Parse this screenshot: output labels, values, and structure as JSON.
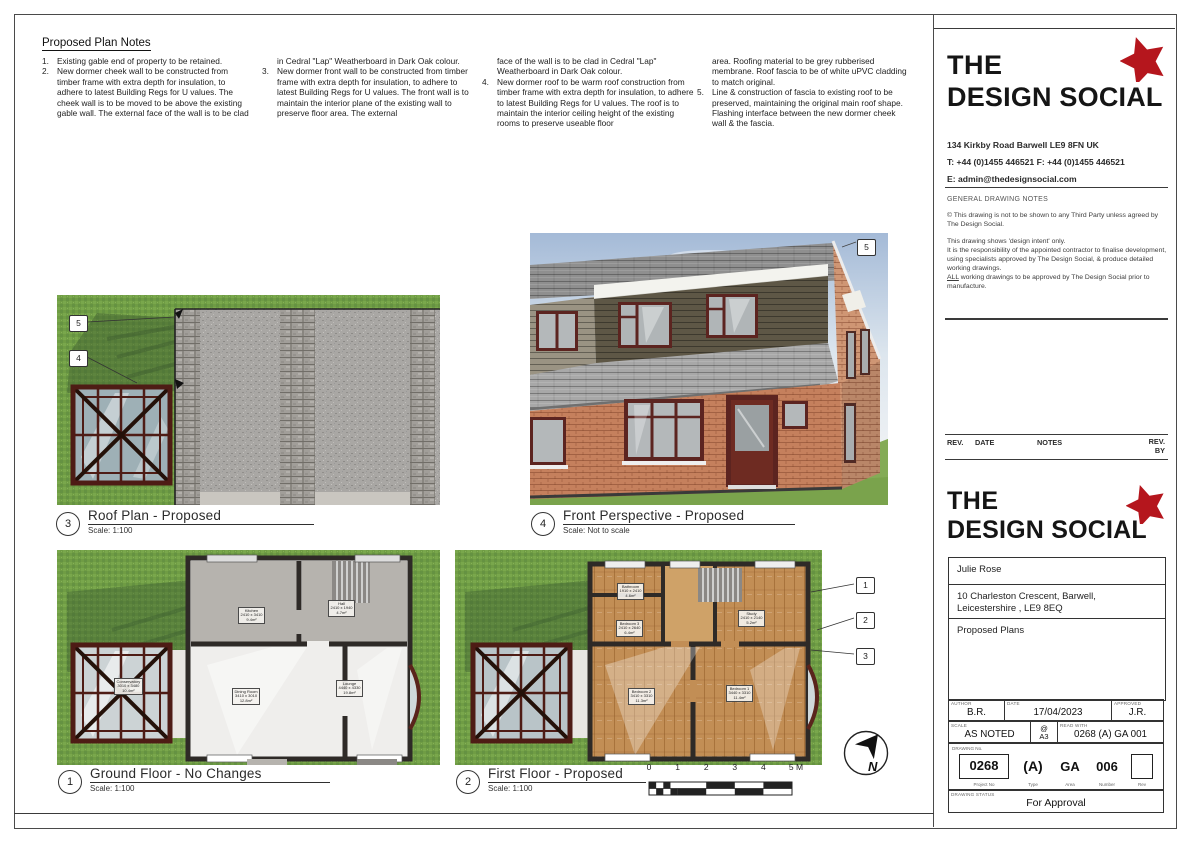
{
  "notes": {
    "heading": "Proposed Plan Notes",
    "columns": [
      {
        "items": [
          {
            "num": "1.",
            "text": "Existing gable end of property to be retained."
          },
          {
            "num": "2.",
            "text": "New dormer cheek wall to be constructed from timber frame with extra depth for insulation, to adhere to latest Building Regs for U values. The cheek wall is to be moved to be above the existing gable wall. The external face of the wall is to be clad"
          }
        ]
      },
      {
        "items": [
          {
            "num": "",
            "text": "in Cedral \"Lap\" Weatherboard in Dark Oak colour."
          },
          {
            "num": "3.",
            "text": "New dormer front wall to be constructed from timber frame with extra depth for insulation, to adhere to latest Building Regs for U values. The front wall is to maintain the interior plane of the existing wall to preserve floor area. The external"
          }
        ]
      },
      {
        "items": [
          {
            "num": "",
            "text": "face of the wall is to be clad in Cedral \"Lap\" Weatherboard in Dark Oak colour."
          },
          {
            "num": "4.",
            "text": "New dormer roof to be warm roof construction from timber frame with extra depth for insulation, to adhere to latest Building Regs for U values. The roof is to maintain the interior ceiling height of the existing rooms to preserve useable floor"
          }
        ]
      },
      {
        "items": [
          {
            "num": "",
            "text": "area. Roofing material to be grey rubberised membrane. Roof fascia to be of white uPVC cladding to match original."
          },
          {
            "num": "5.",
            "text": "Line & construction of fascia to existing roof to be preserved, maintaining the original main roof shape. Flashing interface between the new dormer cheek wall & the fascia."
          }
        ]
      }
    ]
  },
  "drawings": {
    "roof_plan": {
      "number": "3",
      "title": "Roof Plan - Proposed",
      "scale": "Scale: 1:100",
      "markers": [
        "5",
        "4"
      ]
    },
    "perspective": {
      "number": "4",
      "title": "Front Perspective - Proposed",
      "scale": "Scale: Not to scale",
      "marker": "5"
    },
    "ground_floor": {
      "number": "1",
      "title": "Ground Floor - No Changes",
      "scale": "Scale: 1:100",
      "rooms": [
        {
          "name": "Kitchen",
          "dims": "2410 x 3410",
          "area": "9.4m²"
        },
        {
          "name": "Hall",
          "dims": "2410 x 1940",
          "area": "4.7m²"
        },
        {
          "name": "Dining Room",
          "dims": "3410 x 3010",
          "area": "12.8m²"
        },
        {
          "name": "Lounge",
          "dims": "4440 x 4330",
          "area": "19.8m²"
        },
        {
          "name": "Conservatory",
          "dims": "3010 x 3480",
          "area": "10.4m²"
        }
      ]
    },
    "first_floor": {
      "number": "2",
      "title": "First Floor - Proposed",
      "scale": "Scale: 1:100",
      "markers": [
        "1",
        "2",
        "3"
      ],
      "rooms": [
        {
          "name": "Bathroom",
          "dims": "1910 x 2410",
          "area": "4.6m²"
        },
        {
          "name": "Bedroom 3",
          "dims": "2410 x 2640",
          "area": "6.4m²"
        },
        {
          "name": "Study",
          "dims": "2410 x 2140",
          "area": "5.2m²"
        },
        {
          "name": "Bedroom 2",
          "dims": "3410 x 3310",
          "area": "11.3m²"
        },
        {
          "name": "Bedroom 1",
          "dims": "3440 x 3310",
          "area": "11.4m²"
        }
      ]
    }
  },
  "scalebar": {
    "labels": [
      "0",
      "1",
      "2",
      "3",
      "4",
      "5 M"
    ]
  },
  "north_letter": "N",
  "titleblock": {
    "brand": {
      "line1": "THE",
      "line2": "DESIGN SOCIAL"
    },
    "address": "134 Kirkby Road  Barwell  LE9 8FN  UK",
    "phone": "T: +44 (0)1455 446521  F: +44 (0)1455 446521",
    "email": "E: admin@thedesignsocial.com",
    "general_notes_heading": "GENERAL DRAWING NOTES",
    "general_notes": {
      "p1": "© This drawing is not to be shown to any Third Party unless agreed by The Design Social.",
      "p2": "This drawing shows 'design intent' only.",
      "p3": "It is the responsibility of the appointed contractor to finalise development, using specialists approved by The Design Social, & produce detailed working drawings.",
      "p4_lead": "ALL",
      "p4_rest": " working drawings to be approved by The Design Social prior to manufacture."
    },
    "rev_table": {
      "col1": "REV.",
      "col2": "DATE",
      "col3": "NOTES",
      "col4a": "REV.",
      "col4b": "BY"
    },
    "project": {
      "client": "Julie Rose",
      "address_line1": "10 Charleston Crescent, Barwell,",
      "address_line2": "Leicestershire , LE9 8EQ",
      "title": "Proposed Plans"
    },
    "meta": {
      "author_label": "AUTHOR",
      "author": "B.R.",
      "date_label": "DATE",
      "date": "17/04/2023",
      "approved_label": "APPROVED",
      "approved": "J.R.",
      "scale_label": "SCALE",
      "scale": "AS NOTED",
      "at": "@",
      "paper": "A3",
      "read_with_label": "READ WITH",
      "read_with": "0268 (A) GA 001"
    },
    "drawing_no": {
      "label": "DRAWING No.",
      "project_no": "0268",
      "type": "(A)",
      "area": "GA",
      "number": "006",
      "rev": "",
      "sub": {
        "project_no": "Project No",
        "type": "Type",
        "area": "Area",
        "number": "Number",
        "rev": "Rev"
      }
    },
    "status": {
      "label": "DRAWING STATUS",
      "value": "For Approval"
    }
  },
  "colors": {
    "brand_red": "#b5161d",
    "grass_green": "#6f9c44",
    "roof_grey": "#a9a7a4",
    "brick": "#c5805d",
    "dormer_cladding": "#5e5746",
    "wood_floor": "#c28e55"
  }
}
